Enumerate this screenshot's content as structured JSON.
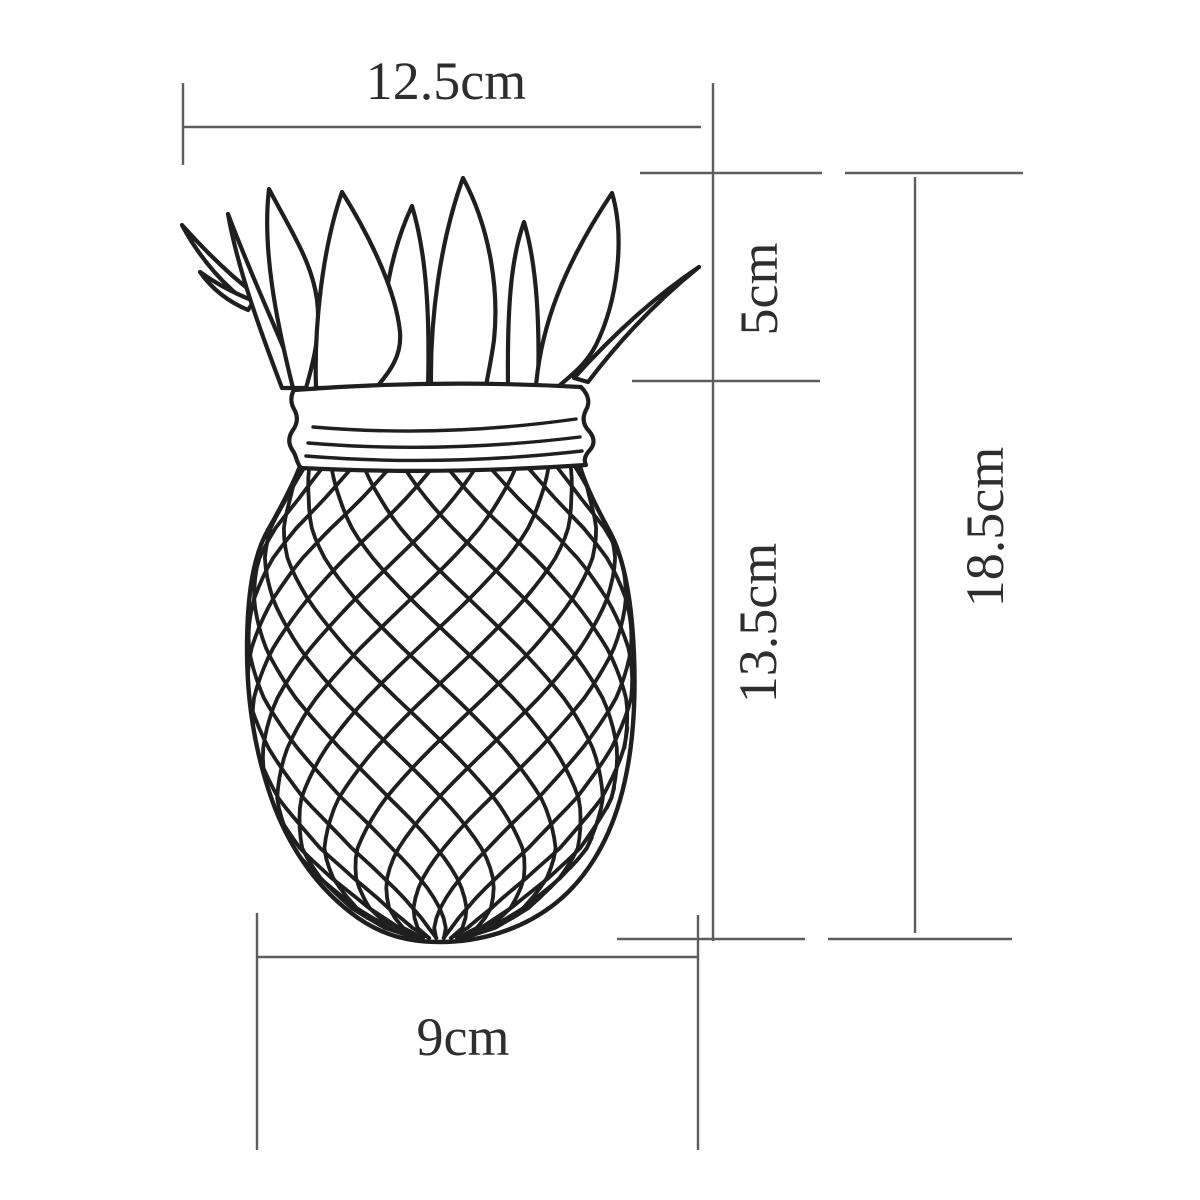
{
  "diagram": {
    "subject": "pineapple mason jar line drawing with measurements",
    "labels": {
      "top_width": "12.5cm",
      "crown_height": "5cm",
      "body_height": "13.5cm",
      "total_height": "18.5cm",
      "base_width": "9cm"
    },
    "colors": {
      "background": "#ffffff",
      "dimension_lines": "#5d5d5d",
      "drawing_stroke": "#1f1f1f",
      "label_text": "#2e2e2e"
    }
  }
}
